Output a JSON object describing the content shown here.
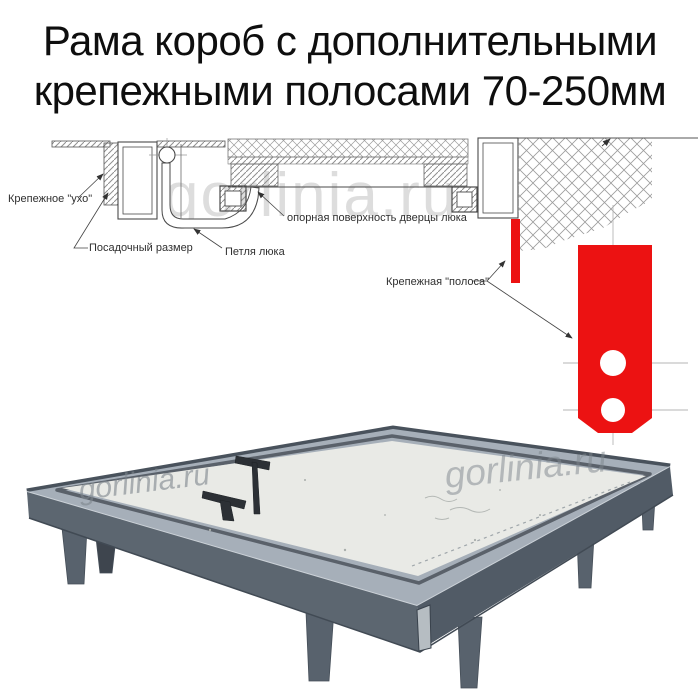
{
  "title": {
    "line1": "Рама короб с дополнительными",
    "line2": "крепежными полосами 70-250мм"
  },
  "diagram": {
    "labels": {
      "ear": "Крепежное \"ухо\"",
      "seat_size": "Посадочный размер",
      "hinge": "Петля люка",
      "support_surface": "опорная поверхность дверцы люка",
      "mount_strip": "Крепежная \"полоса\""
    },
    "accent_red": "#ec1212"
  },
  "watermark": {
    "text": "gorlinia.ru"
  }
}
